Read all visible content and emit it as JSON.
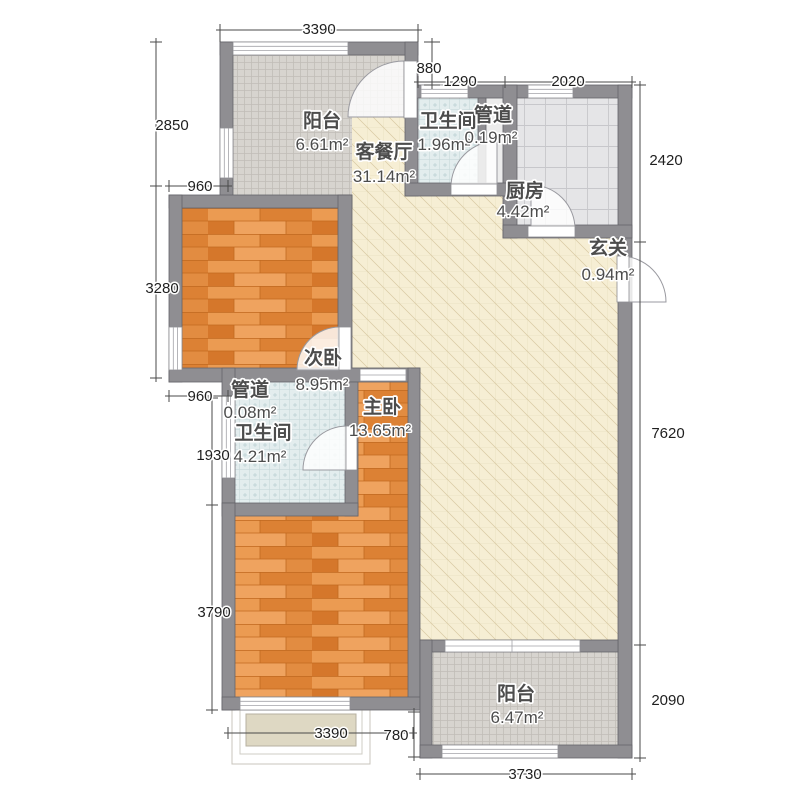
{
  "plan": {
    "rooms": {
      "balcony_top": {
        "name": "阳台",
        "area": "6.61m²"
      },
      "living_dining": {
        "name": "客餐厅",
        "area": "31.14m²"
      },
      "bath_top": {
        "name": "卫生间",
        "area": "1.96m²"
      },
      "duct_top": {
        "name": "管道",
        "area": "0.19m²"
      },
      "kitchen": {
        "name": "厨房",
        "area": "4.42m²"
      },
      "entry": {
        "name": "玄关",
        "area": "0.94m²"
      },
      "bedroom_second": {
        "name": "次卧",
        "area": "8.95m²"
      },
      "duct_mid": {
        "name": "管道",
        "area": "0.08m²"
      },
      "bath_mid": {
        "name": "卫生间",
        "area": "4.21m²"
      },
      "bedroom_master": {
        "name": "主卧",
        "area": "13.65m²"
      },
      "balcony_bottom": {
        "name": "阳台",
        "area": "6.47m²"
      }
    },
    "dimensions": {
      "top_3390": "3390",
      "top_880": "880",
      "top_1290": "1290",
      "top_2020": "2020",
      "right_2420": "2420",
      "right_7620": "7620",
      "right_2090": "2090",
      "left_2850": "2850",
      "left_960_upper": "960",
      "left_3280": "3280",
      "left_960_lower": "960",
      "left_1930": "1930",
      "left_3790": "3790",
      "bottom_3390": "3390",
      "bottom_780": "780",
      "bottom_3730": "3730"
    },
    "colors": {
      "wall": "#8f8e92",
      "wood_floor": "#e0893f",
      "living_floor": "#f6eed4",
      "balcony_tile": "#d7d4cf",
      "bath_tile": "#e3edee",
      "kitchen_tile": "#e5e5e7"
    }
  }
}
